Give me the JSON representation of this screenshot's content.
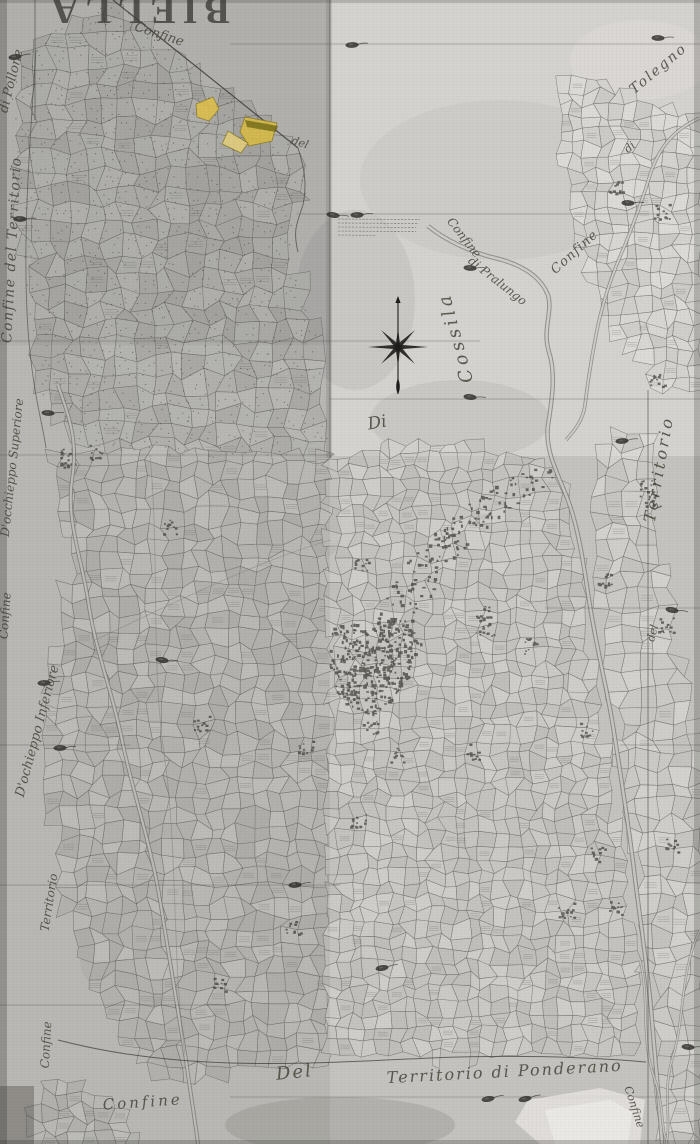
{
  "document": {
    "kind": "scanned historical cadastral map",
    "title": "BIELLA",
    "title_rotated_180": true
  },
  "palette": {
    "paper": "#cbc9c5",
    "paper_light": "#d5d3cf",
    "paper_dark": "#b6b4b0",
    "ink": "#474439",
    "parcel_line": "#6e6b64",
    "water_line": "#83807a",
    "water_fill": "#cfcdc9",
    "buildings": "#4e4b45",
    "stipple": "#47453e",
    "seal": "#2e2c28",
    "highlight_yellow": "#dfc04a",
    "highlight_pale": "#e4cf7d"
  },
  "labels": [
    {
      "id": "title-biella",
      "text": "BIELLA",
      "x": 137,
      "y": -2,
      "rotate": 180,
      "size": 38,
      "tracking": 7,
      "title": true
    },
    {
      "id": "confine-top-diagonal",
      "text": "Confine",
      "x": 158,
      "y": 38,
      "rotate": 18,
      "size": 13
    },
    {
      "id": "di-pollone",
      "text": "di Pollone",
      "x": 15,
      "y": 82,
      "rotate": -76,
      "size": 13
    },
    {
      "id": "confine-del-territorio-left",
      "text": "Confine del Territorio",
      "x": 16,
      "y": 250,
      "rotate": -87,
      "size": 14,
      "tracking": 1.5
    },
    {
      "id": "docchieppo-superiore",
      "text": "D'occhieppo Superiore",
      "x": 16,
      "y": 468,
      "rotate": -84,
      "size": 12
    },
    {
      "id": "confine-left-mid",
      "text": "Confine",
      "x": 9,
      "y": 616,
      "rotate": -86,
      "size": 12
    },
    {
      "id": "dochieppo-inferiore",
      "text": "D'ochieppo Inferiore",
      "x": 41,
      "y": 732,
      "rotate": -75,
      "size": 13
    },
    {
      "id": "territorio-left-lower",
      "text": "Territorio",
      "x": 53,
      "y": 903,
      "rotate": -81,
      "size": 12
    },
    {
      "id": "confine-left-bottom",
      "text": "Confine",
      "x": 50,
      "y": 1045,
      "rotate": -87,
      "size": 12
    },
    {
      "id": "confine-bottom-left",
      "text": "Confine",
      "x": 143,
      "y": 1107,
      "rotate": -4,
      "size": 15,
      "tracking": 3
    },
    {
      "id": "del-bottom",
      "text": "Del",
      "x": 295,
      "y": 1078,
      "rotate": -6,
      "size": 18,
      "tracking": 2
    },
    {
      "id": "territorio-di-ponderano",
      "text": "Territorio di Ponderano",
      "x": 505,
      "y": 1077,
      "rotate": -3,
      "size": 16,
      "tracking": 2
    },
    {
      "id": "confine-bottom-right",
      "text": "Confine",
      "x": 631,
      "y": 1108,
      "rotate": 72,
      "size": 11
    },
    {
      "id": "territorio-right",
      "text": "Territorio",
      "x": 664,
      "y": 470,
      "rotate": -80,
      "size": 16,
      "tracking": 3
    },
    {
      "id": "del-right",
      "text": "del",
      "x": 656,
      "y": 634,
      "rotate": -75,
      "size": 11
    },
    {
      "id": "tolegno",
      "text": "Tolegno",
      "x": 661,
      "y": 72,
      "rotate": -40,
      "size": 14,
      "tracking": 2
    },
    {
      "id": "di-tolegno",
      "text": "di",
      "x": 632,
      "y": 150,
      "rotate": -40,
      "size": 11
    },
    {
      "id": "confine-right",
      "text": "Confine",
      "x": 577,
      "y": 255,
      "rotate": -42,
      "size": 13,
      "tracking": 1
    },
    {
      "id": "confine-pralungo",
      "text": "Confine",
      "x": 461,
      "y": 240,
      "rotate": 52,
      "size": 12
    },
    {
      "id": "di-pralungo",
      "text": "di Pralungo",
      "x": 495,
      "y": 284,
      "rotate": 38,
      "size": 12
    },
    {
      "id": "cossila",
      "text": "Cossila",
      "x": 461,
      "y": 336,
      "rotate": -105,
      "size": 18,
      "tracking": 4
    },
    {
      "id": "di-center",
      "text": "Di",
      "x": 378,
      "y": 428,
      "rotate": -10,
      "size": 17
    },
    {
      "id": "del-top",
      "text": "del",
      "x": 299,
      "y": 146,
      "rotate": 18,
      "size": 11
    }
  ],
  "compass": {
    "cx": 398,
    "cy": 347,
    "needle_top": 297,
    "needle_bottom": 394,
    "ray_ew": 30,
    "ray_diag": 24,
    "ray_ns": 19
  },
  "highlighted_parcels": [
    {
      "id": "yellow-parcel-small",
      "points": [
        [
          196,
          104
        ],
        [
          213,
          97
        ],
        [
          219,
          109
        ],
        [
          209,
          121
        ],
        [
          197,
          117
        ]
      ],
      "fill": "#dfc04a"
    },
    {
      "id": "yellow-parcel-large",
      "points": [
        [
          245,
          117
        ],
        [
          277,
          123
        ],
        [
          272,
          141
        ],
        [
          249,
          146
        ],
        [
          240,
          132
        ]
      ],
      "fill": "#d9bc45",
      "dark_band": true
    },
    {
      "id": "yellow-parcel-pale",
      "points": [
        [
          228,
          131
        ],
        [
          248,
          143
        ],
        [
          241,
          153
        ],
        [
          222,
          144
        ]
      ],
      "fill": "#e4cf7d"
    }
  ],
  "illegible_note": {
    "x": 338,
    "y": 219,
    "width": 84,
    "lines": 5
  },
  "seal_marks": [
    [
      15,
      57
    ],
    [
      20,
      219
    ],
    [
      352,
      45
    ],
    [
      658,
      38
    ],
    [
      333,
      215
    ],
    [
      357,
      215
    ],
    [
      628,
      203
    ],
    [
      470,
      268
    ],
    [
      48,
      413
    ],
    [
      470,
      397
    ],
    [
      622,
      441
    ],
    [
      44,
      683
    ],
    [
      60,
      748
    ],
    [
      672,
      610
    ],
    [
      295,
      885
    ],
    [
      382,
      968
    ],
    [
      488,
      1099
    ],
    [
      525,
      1099
    ],
    [
      688,
      1047
    ],
    [
      162,
      660
    ]
  ]
}
